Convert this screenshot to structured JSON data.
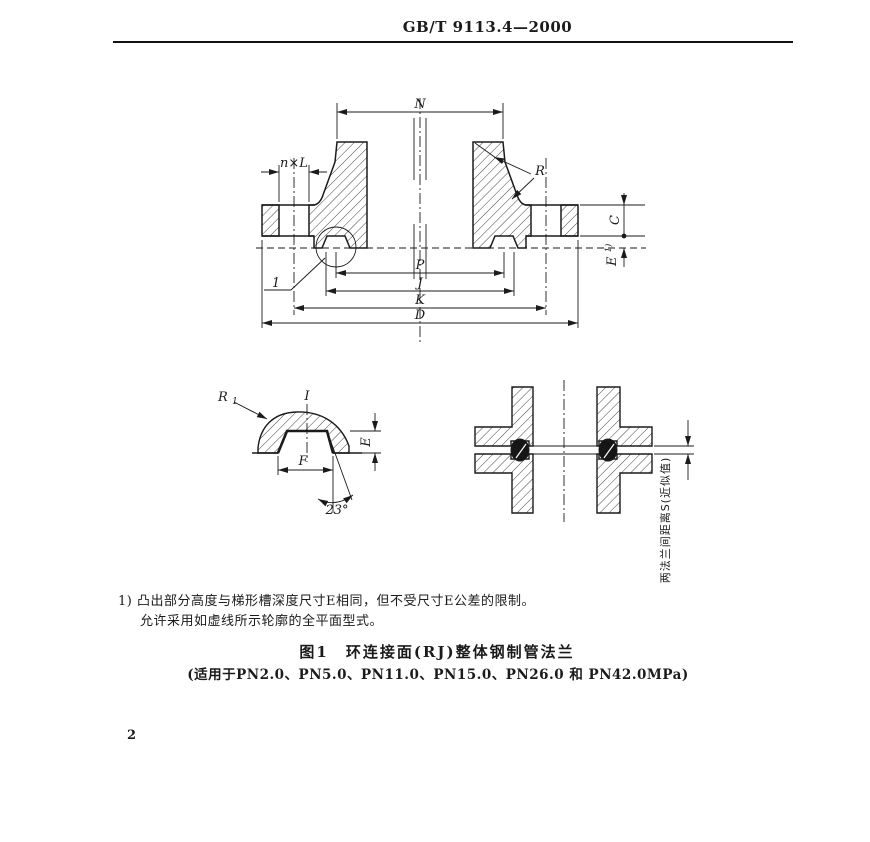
{
  "page": {
    "header": "GB/T 9113.4—2000",
    "page_number": "2"
  },
  "figure": {
    "footnote_line1": "1) 凸出部分高度与梯形槽深度尺寸E相同，但不受尺寸E公差的限制。",
    "footnote_line2": "允许采用如虚线所示轮廓的全平面型式。",
    "caption_line1": "图1　环连接面(RJ)整体钢制管法兰",
    "caption_line2": "(适用于PN2.0、PN5.0、PN11.0、PN15.0、PN26.0 和 PN42.0MPa)",
    "labels": {
      "dim_n": "N",
      "dim_nxl": "n×L",
      "dim_r": "R",
      "dim_c": "C",
      "dim_e_main": "E",
      "dim_e_sup": "1)",
      "dim_p": "P",
      "dim_j": "J",
      "dim_k": "K",
      "dim_d": "D",
      "detail_ref": "1",
      "detail_marker": "Ⅰ",
      "r1_base": "R",
      "r1_sub": "1",
      "dim_e_detail": "E",
      "dim_f": "F",
      "angle": "23°",
      "assembly_note": "两法兰间距离S(近似值)"
    }
  }
}
